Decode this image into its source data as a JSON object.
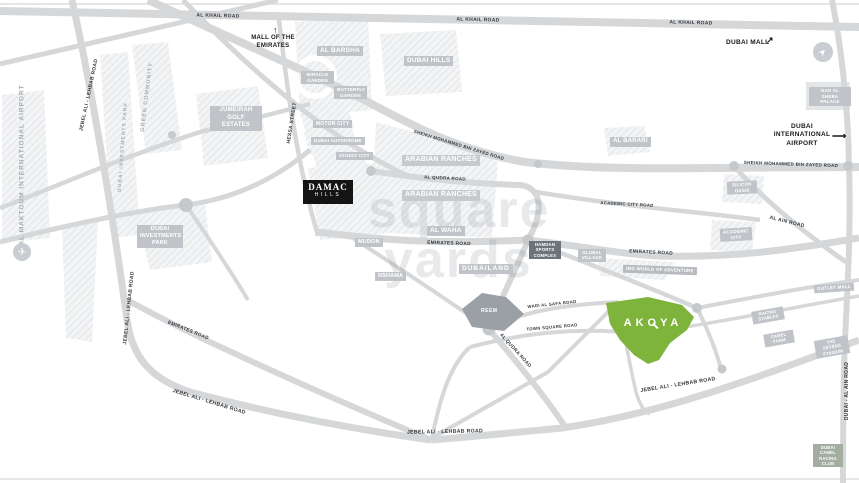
{
  "map": {
    "watermark": {
      "line1": "square",
      "line2": "yards"
    },
    "roads": {
      "al_khail": "AL KHAIL ROAD",
      "smbz": "SHEIKH MOHAMMED BIN ZAYED ROAD",
      "al_qudra": "AL QUDRA ROAD",
      "emirates": "EMIRATES ROAD",
      "jebel_ali_lehbab": "JEBEL ALI - LEHBAB ROAD",
      "academic_city": "ACADEMIC CITY ROAD",
      "al_ain": "AL AIN ROAD",
      "dubai_al_ain": "DUBAI - AL AIN ROAD",
      "hessa": "HESSA STREET",
      "wadi_al_safa": "WADI AL SAFA ROAD",
      "town_square": "TOWN SQUARE ROAD"
    },
    "areas": {
      "al_barsha": "AL BARSHA",
      "dubai_hills": "DUBAI HILLS",
      "jumeirah_golf_estates": "JUMEIRAH GOLF ESTATES",
      "miracle_garden": "MIRACLE GARDEN",
      "butterfly_garden": "BUTTERFLY GARDEN",
      "motor_city": "MOTOR CITY",
      "dubai_autodrome": "DUBAI AUTODROME",
      "studio_city": "STUDIO CITY",
      "damac_line1": "DAMAC",
      "damac_line2": "HILLS",
      "arabian_ranches": "ARABIAN RANCHES",
      "al_waha": "AL WAHA",
      "mudon": "MUDON",
      "nshama": "NSHAMA",
      "dubailand": "DUBAILAND",
      "reem": "REEM",
      "hamdan_sports_complex": "HAMDAN SPORTS COMPLEX",
      "global_village": "GLOBAL VILLAGE",
      "img_world": "IMG WORLD OF ADVENTURE",
      "al_barari": "AL BARARI",
      "silicon_oasis": "SILICON OASIS",
      "academic_city": "ACADEMIC CITY",
      "nad_al_sheba_palace": "NAD AL SHEBA PALACE",
      "outlet_mall": "OUTLET MALL",
      "racing_stables": "RACING STABLES",
      "camel_farm": "CAMEL FARM",
      "sevens_stadium": "THE SEVENS STADIUM",
      "camel_racing_club": "DUBAI CAMEL RACING CLUB",
      "green_community": "GREEN COMMUNITY",
      "dubai_investments_park": "DUBAI INVESTMENTS PARK",
      "al_maktoum_airport": "AL MAKTOUM INTERNATIONAL AIRPORT"
    },
    "landmarks": {
      "mall_of_the_emirates": "MALL OF THE EMIRATES",
      "dubai_mall": "DUBAI MALL",
      "dubai_international_airport": "DUBAI INTERNATIONAL AIRPORT"
    },
    "project": {
      "name": "AKOYA"
    },
    "icons": {
      "plane": "✈",
      "arrow_up": "↑",
      "arrow_ne": "↗",
      "arrow_right": "⟶",
      "compass": "➤"
    },
    "colors": {
      "akoya_green": "#7eb33c",
      "road_gray": "#d5d7d9",
      "label_gray": "#c0c4c9",
      "dark_label": "#6d737a",
      "damac_black": "#141414"
    }
  }
}
